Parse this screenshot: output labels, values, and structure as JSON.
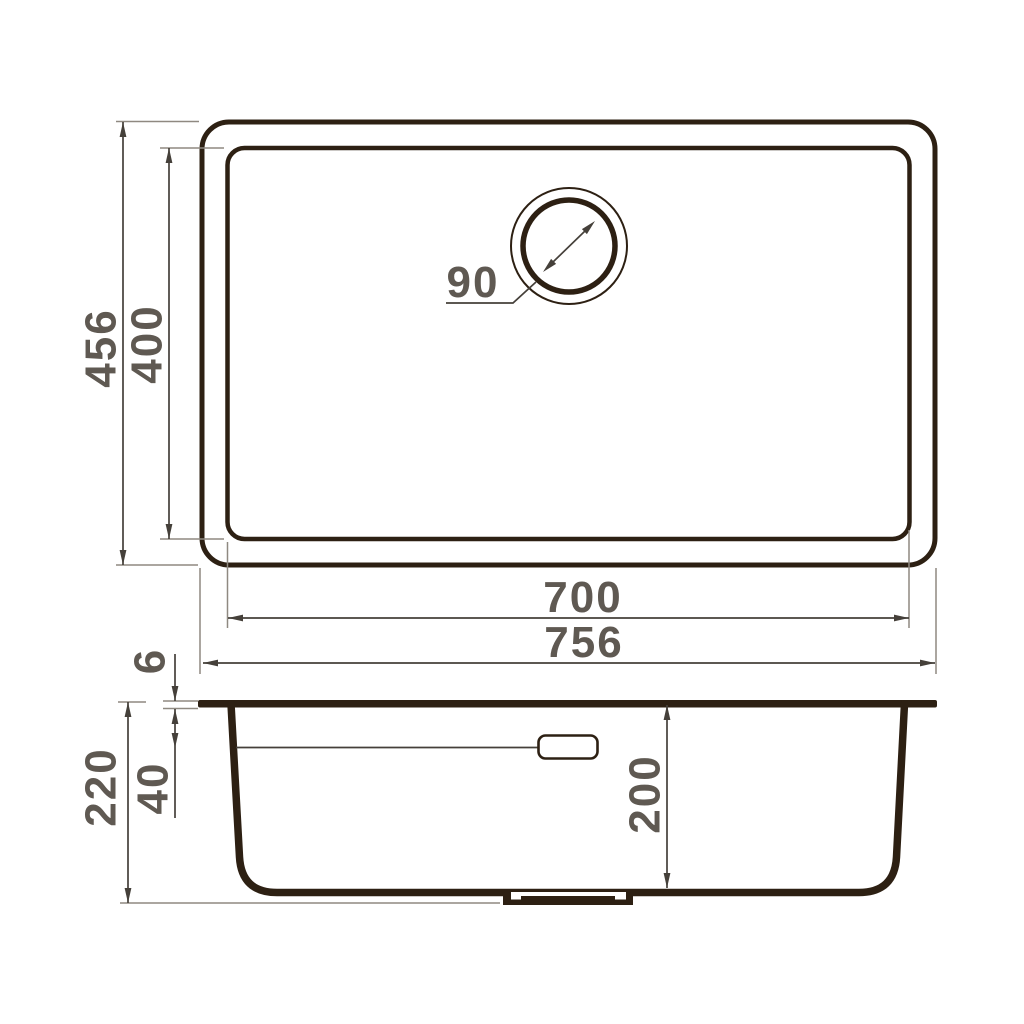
{
  "drawing": {
    "title": "undermount-sink-technical-drawing",
    "views": {
      "top": {
        "labels": {
          "outer_height": "456",
          "inner_height": "400",
          "drain_diameter": "90",
          "inner_width": "700",
          "outer_width": "756"
        }
      },
      "section": {
        "labels": {
          "total_height": "220",
          "rim_thickness": "6",
          "overflow_offset": "40",
          "bowl_depth": "200"
        }
      }
    }
  },
  "colors": {
    "background": "#ffffff",
    "outline": "#2d2013",
    "dimension": "#45403a",
    "extension": "#8f8981",
    "label": "#5f5952"
  }
}
